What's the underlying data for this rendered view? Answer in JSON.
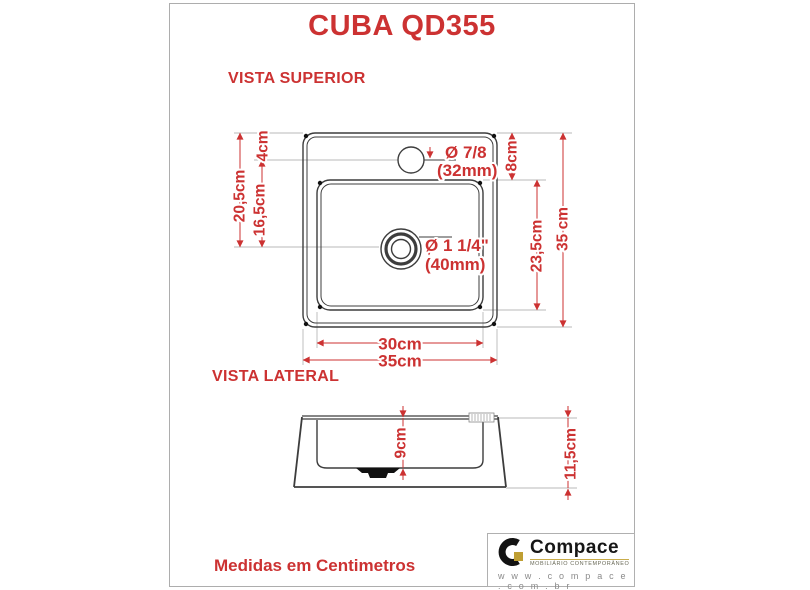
{
  "title": "CUBA QD355",
  "colors": {
    "accent_red": "#cc3232",
    "drawing_line": "#3d3d3d",
    "brand_gold": "#bf9f33"
  },
  "views": {
    "superior": {
      "label": "VISTA SUPERIOR",
      "dimensions": {
        "rim_to_hole": "4cm",
        "rim_to_drain": "20,5cm",
        "hole_to_drain": "16,5cm",
        "faucet_hole_diameter": "Ø 7/8",
        "faucet_hole_diameter_mm": "(32mm)",
        "rim_to_basin": "8cm",
        "drain_diameter": "Ø 1 1/4\"",
        "drain_diameter_mm": "(40mm)",
        "basin_height": "23,5cm",
        "total_height": "35 cm",
        "basin_width": "30cm",
        "total_width": "35cm"
      }
    },
    "lateral": {
      "label": "VISTA LATERAL",
      "dimensions": {
        "basin_depth": "9cm",
        "total_height": "11,5cm"
      }
    }
  },
  "footer": {
    "note": "Medidas em Centimetros"
  },
  "brand": {
    "name": "Compace",
    "tagline": "MOBILIÁRIO CONTEMPORÂNEO",
    "website": "w w w . c o m p a c e . c o m . b r"
  }
}
